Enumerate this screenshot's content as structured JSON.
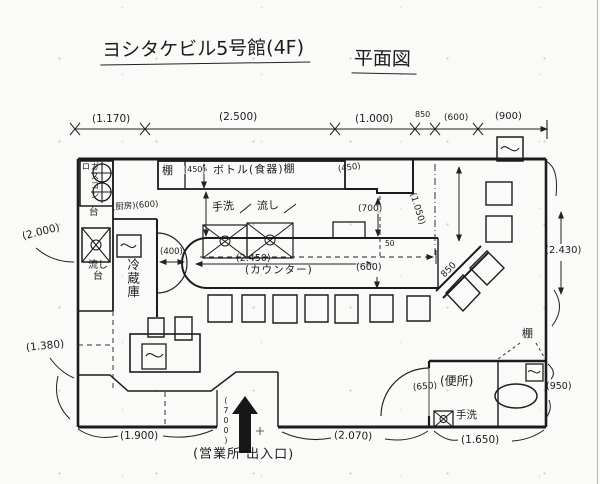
{
  "title": {
    "main": "ヨシタケビル5号館(4F)",
    "suffix": "平面図"
  },
  "dimensions": {
    "top": [
      "(1.170)",
      "(2.500)",
      "(1.000)",
      "850",
      "(600)",
      "(900)"
    ],
    "left": [
      "(2.000)",
      "(1.380)"
    ],
    "right": [
      "(2.430)",
      "(950)"
    ],
    "bottom": [
      "(1.900)",
      "(2.070)",
      "(1.650)"
    ],
    "entrance_width": "(700)",
    "interior": {
      "shelf_depth": "(450)",
      "right_wall_shelf": "(450)",
      "kitchen_aisle": "(厨房)(600)",
      "door_passage": "(400)",
      "counter_length": "(2.450)",
      "counter_depth": "(600)",
      "counter_to_wall": "(700)",
      "gap_50": "50",
      "right_section": "(1.050)",
      "diagonal": "850",
      "toilet_door": "(650)"
    }
  },
  "rooms": {
    "shelf": "棚",
    "bottle_shelf": "ボトル(食器)棚",
    "gas_stove": "ガスコンロ",
    "stove_stand": "台",
    "sink_unit": "流し\n台",
    "refrigerator": "冷蔵庫",
    "counter_handwash": "手洗",
    "counter_sink": "流し",
    "counter": "(カウンター)",
    "toilet": "(便所)",
    "toilet_handwash": "手洗",
    "toilet_shelf": "棚",
    "entrance": "(営業所 出入口)"
  },
  "symbols": {
    "wave_box": "equipment/air-conditioner box with S-curve",
    "burner": "gas burner circle with cross",
    "crossed_box": "sink / wash basin (box with X)",
    "door_arc": "door swing arc",
    "entrance_arrow": "solid black arrow into entrance"
  }
}
